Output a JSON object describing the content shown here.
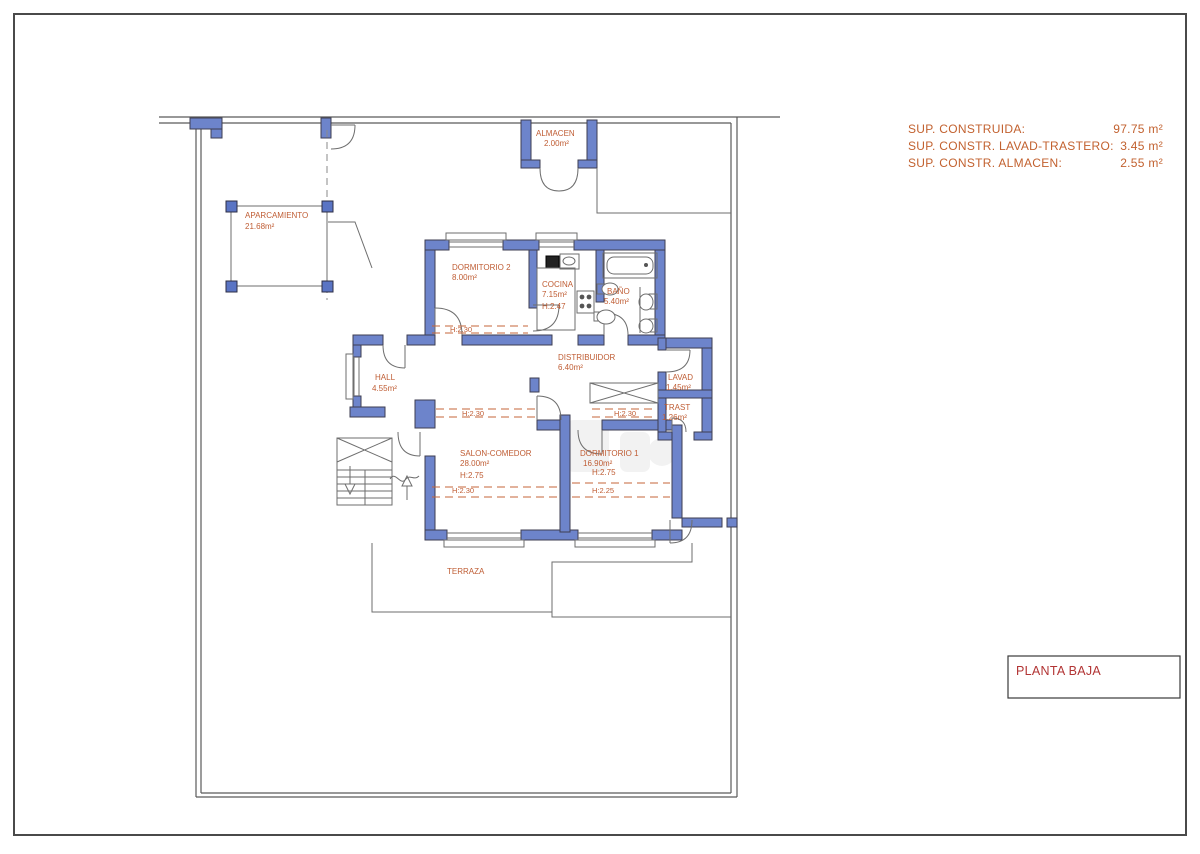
{
  "page": {
    "title": "PLANTA BAJA"
  },
  "summary": {
    "rows": [
      {
        "label": "SUP. CONSTRUIDA:",
        "value": "97.75 m²"
      },
      {
        "label": "SUP. CONSTR. LAVAD-TRASTERO:",
        "value": "3.45 m²"
      },
      {
        "label": "SUP. CONSTR. ALMACEN:",
        "value": "2.55 m²"
      }
    ]
  },
  "rooms": {
    "almacen": {
      "name": "ALMACEN",
      "area": "2.00m²"
    },
    "aparcamiento": {
      "name": "APARCAMIENTO",
      "area": "21.68m²"
    },
    "dormitorio2": {
      "name": "DORMITORIO 2",
      "area": "8.00m²"
    },
    "cocina": {
      "name": "COCINA",
      "area": "7.15m²",
      "height": "H:2.47"
    },
    "bano": {
      "name": "BAÑO",
      "area": "5.40m²"
    },
    "hall": {
      "name": "HALL",
      "area": "4.55m²"
    },
    "distribuidor": {
      "name": "DISTRIBUIDOR",
      "area": "6.40m²"
    },
    "lavadero": {
      "name": "LAVAD",
      "area": "1.45m²"
    },
    "trastero": {
      "name": "TRAST",
      "area": "1.26m²"
    },
    "salon": {
      "name": "SALON-COMEDOR",
      "area": "28.00m²",
      "height": "H:2.75"
    },
    "dormitorio1": {
      "name": "DORMITORIO 1",
      "area": "16.90m²",
      "height": "H:2.75"
    },
    "terraza": {
      "name": "TERRAZA"
    }
  },
  "levels": {
    "h230": "H:2.30",
    "h225": "H:2.25"
  },
  "colors": {
    "wall_fill": "#6d84cb",
    "wall_stroke": "#3e3e52",
    "label_orange": "#bf5c33",
    "title_red": "#b23434",
    "thin_line": "#6e6e6e"
  }
}
